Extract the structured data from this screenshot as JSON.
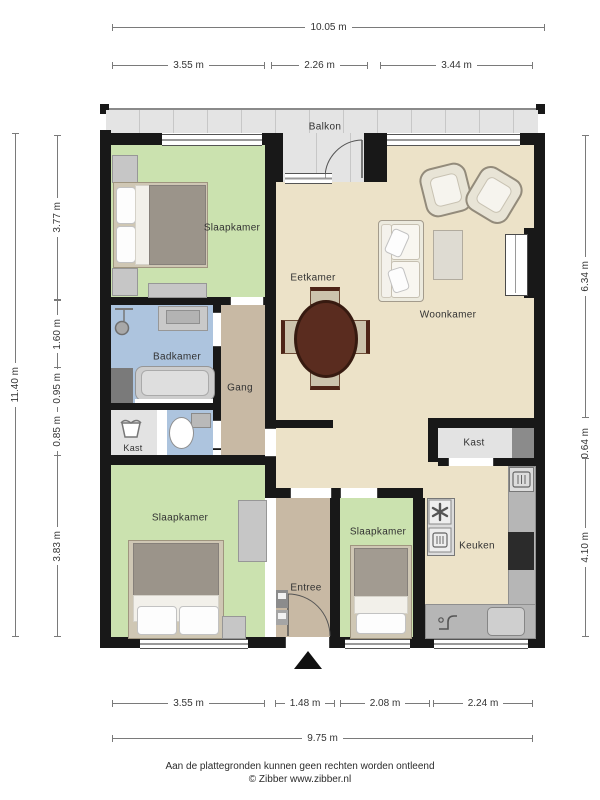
{
  "rooms": {
    "balkon": "Balkon",
    "slaapkamer_1": "Slaapkamer",
    "eetkamer": "Eetkamer",
    "woonkamer": "Woonkamer",
    "badkamer": "Badkamer",
    "gang": "Gang",
    "kast_left": "Kast",
    "slaapkamer_2": "Slaapkamer",
    "entree": "Entree",
    "slaapkamer_3": "Slaapkamer",
    "keuken": "Keuken",
    "kast_right": "Kast"
  },
  "dimensions": {
    "top": {
      "overall": "10.05 m",
      "segments": [
        "3.55 m",
        "2.26 m",
        "3.44 m"
      ]
    },
    "bottom": {
      "overall": "9.75 m",
      "segments": [
        "3.55 m",
        "1.48 m",
        "2.08 m",
        "2.24 m"
      ]
    },
    "left": {
      "overall": "11.40 m",
      "segments": [
        "3.77 m",
        "1.60 m",
        "0.95 m",
        "0.85 m",
        "3.83 m"
      ]
    },
    "right": {
      "segments": [
        "6.34 m",
        "0.64 m",
        "4.10 m"
      ]
    }
  },
  "footer": {
    "line1": "Aan de plattegronden kunnen geen rechten worden ontleend",
    "line2": "© Zibber www.zibber.nl"
  },
  "icons": [
    "laundry-basket-icon",
    "shower-icon",
    "toilet-icon",
    "extractor-fan-icon",
    "oven-icon",
    "dishwasher-icon",
    "faucet-icon",
    "entrance-arrow-icon"
  ],
  "colors": {
    "wall": "#181818",
    "green": "#cbe2af",
    "blue": "#adc4de",
    "tan": "#c8b9a4",
    "cream": "#ece2c8",
    "balcony": "#e4e4e4",
    "closet": "#e3e3e3",
    "counter": "#b6b6b6"
  }
}
